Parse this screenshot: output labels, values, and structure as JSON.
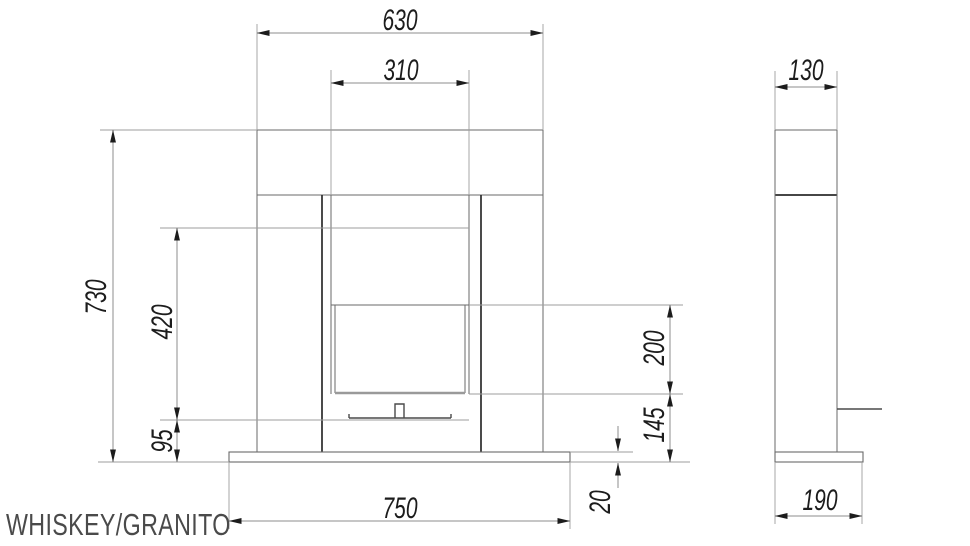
{
  "title": "WHISKEY/GRANITO",
  "drawing_type": "fireplace technical drawing, front and side elevation",
  "dimensions": {
    "shelf_width": "630",
    "firebox_width": "310",
    "total_height": "730",
    "firebox_height": "420",
    "burner_to_floor": "95",
    "glass_height": "200",
    "glass_bottom_to_floor": "145",
    "base_thickness": "20",
    "base_width": "750",
    "depth_top": "130",
    "depth_base": "190"
  },
  "colors": {
    "background": "#ffffff",
    "object_line": "#6a6a6a",
    "object_line_dark": "#2b2b2b",
    "extension_line": "#9e9e9e",
    "dimension_line": "#8c8c8c",
    "arrow_and_text": "#1c1c1c",
    "title_text": "#4a4a4a"
  }
}
